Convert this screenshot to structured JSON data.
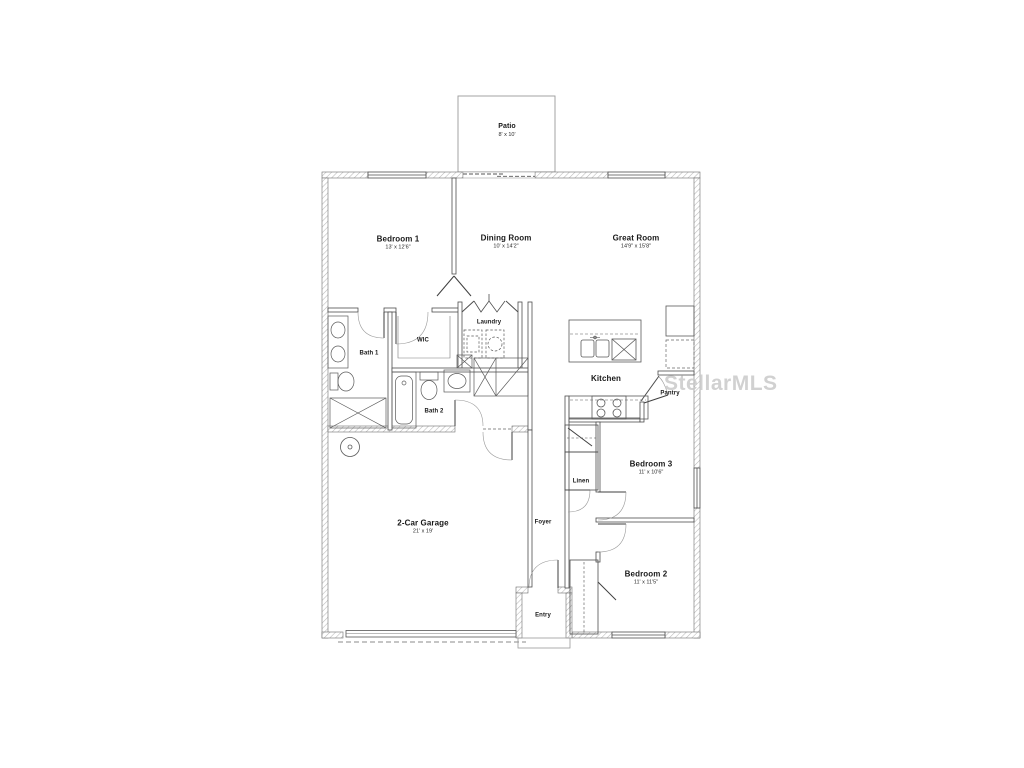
{
  "watermark": "StellarMLS",
  "colors": {
    "wall_line": "#4d4d4d",
    "hatch": "#b8b8b8",
    "fixture_line": "#5a5a5a",
    "watermark": "#c9c9c9",
    "text": "#191919"
  },
  "rooms": {
    "patio": {
      "name": "Patio",
      "dims": "8' x 10'"
    },
    "bedroom1": {
      "name": "Bedroom 1",
      "dims": "13' x 12'6\""
    },
    "dining": {
      "name": "Dining Room",
      "dims": "10' x 14'2\""
    },
    "great": {
      "name": "Great Room",
      "dims": "14'9\" x 15'8\""
    },
    "bath1": {
      "name": "Bath 1"
    },
    "wic": {
      "name": "WIC"
    },
    "laundry": {
      "name": "Laundry"
    },
    "bath2": {
      "name": "Bath 2"
    },
    "kitchen": {
      "name": "Kitchen"
    },
    "pantry": {
      "name": "Pantry"
    },
    "linen": {
      "name": "Linen"
    },
    "bedroom3": {
      "name": "Bedroom 3",
      "dims": "11' x 10'6\""
    },
    "foyer": {
      "name": "Foyer"
    },
    "garage": {
      "name": "2-Car Garage",
      "dims": "21' x 19'"
    },
    "bedroom2": {
      "name": "Bedroom 2",
      "dims": "11' x 11'5\""
    },
    "entry": {
      "name": "Entry"
    }
  }
}
